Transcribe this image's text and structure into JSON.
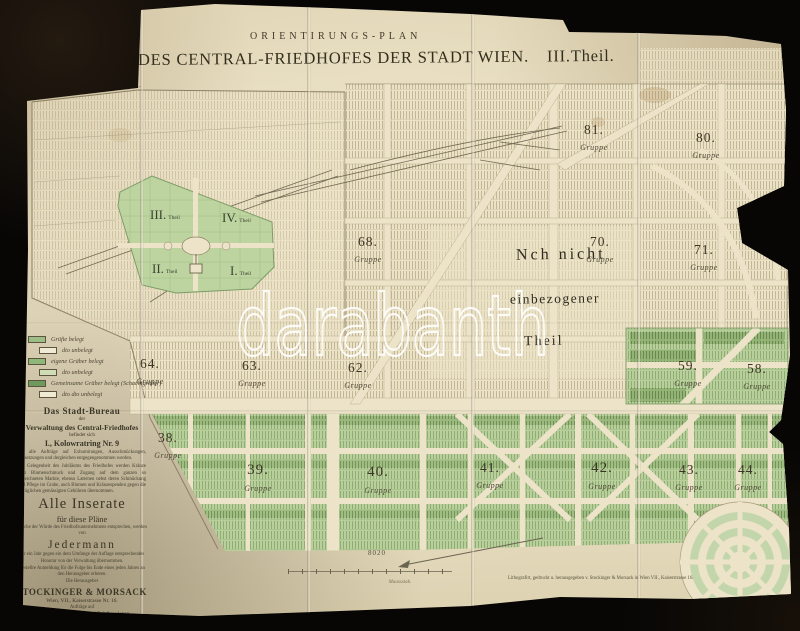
{
  "meta": {
    "background_color": "#070605",
    "paper_color": "#e9dfc2",
    "ink_color": "#3b3526",
    "green_light": "#b9d09c",
    "green_dark": "#6f9a5d",
    "watermark_color": "#ffffff"
  },
  "title": {
    "overline": "ORIENTIRUNGS-PLAN",
    "main": "DES CENTRAL-FRIEDHOFES DER STADT WIEN.",
    "part": "III.Theil."
  },
  "watermark": "darabanth",
  "map": {
    "group_word": "Gruppe",
    "groups": [
      "81.",
      "80.",
      "68.",
      "70.",
      "71.",
      "64.",
      "63.",
      "62.",
      "59.",
      "58.",
      "38.",
      "39.",
      "40.",
      "41.",
      "42.",
      "43.",
      "44."
    ],
    "old_parts": [
      "III.",
      "IV.",
      "II.",
      "I."
    ],
    "theil_word": "Theil",
    "unassigned": {
      "line1": "Nch nicht",
      "line2": "einbezogener",
      "line3": "Theil"
    }
  },
  "legend": {
    "items": [
      {
        "label": "Grüfte belegt",
        "color": "#9cbd85"
      },
      {
        "label": "dto unbelegt",
        "color": "#f0e9d4"
      },
      {
        "label": "eigene Gräber belegt",
        "color": "#8db87a"
      },
      {
        "label": "dto unbelegt",
        "color": "#cfdcb6"
      },
      {
        "label": "Gemeinsame Gräber belegt (Schachtgräber)",
        "color": "#6f9a5d"
      },
      {
        "label": "dto dto unbelegt",
        "color": "#f0e9d4"
      }
    ]
  },
  "bureau": {
    "heading": "Das Stadt-Bureau",
    "sub1": "der",
    "line1": "Verwaltung des Central-Friedhofes",
    "sub2": "befindet sich",
    "address": "I., Kolowratring Nr. 9",
    "para1": "wo alle Aufträge auf Exhumirungen, Ausschmückungen, Beisetzungen und dergleichen entgegengenommen werden.",
    "para2": "Bei Gelegenheit des Jubiläums des Friedhofes werden Kränze zum Blumenschmuck und Zugang auf dem ganzen so bezeichneten Markte, ebenso Laternen nebst deren Schmückung und Pflege im Grabe, auch Blumen und Kränzespenden gegen die bezüglichen gemässigten Gebühren übernommen."
  },
  "inserate": {
    "heading": "Alle Inserate",
    "sub": "für diese Pläne",
    "line1": "welche der Würde des Friedhofsunternehmens entsprechen, werden von",
    "jedermann": "Jedermann",
    "para1": "für ein Jahr gegen ein dem Umfange der Auflage entsprechendes Honorar von der Verwaltung übernommen.",
    "para2": "Bestellte Anmeldung für die Folge bis Ende eines jeden Jahres an den Herausgeber erbeten.",
    "line2": "Die Herausgeber",
    "publisher": "STOCKINGER & MORSACK",
    "publisher_address": "Wien, VII., Kaiserstrasse Nr. 16.",
    "line3": "Aufträge auf",
    "line4": "Parten, Trauerkarten und Briefpapieren",
    "line5": "werden daselbst übernommen."
  },
  "scale": {
    "value": "8020",
    "caption": "Maassstab."
  },
  "imprint": "Lithografirt, gedruckt u. herausgegeben v. Stockinger & Morsack in Wien VII., Kaiserstrasse 16."
}
